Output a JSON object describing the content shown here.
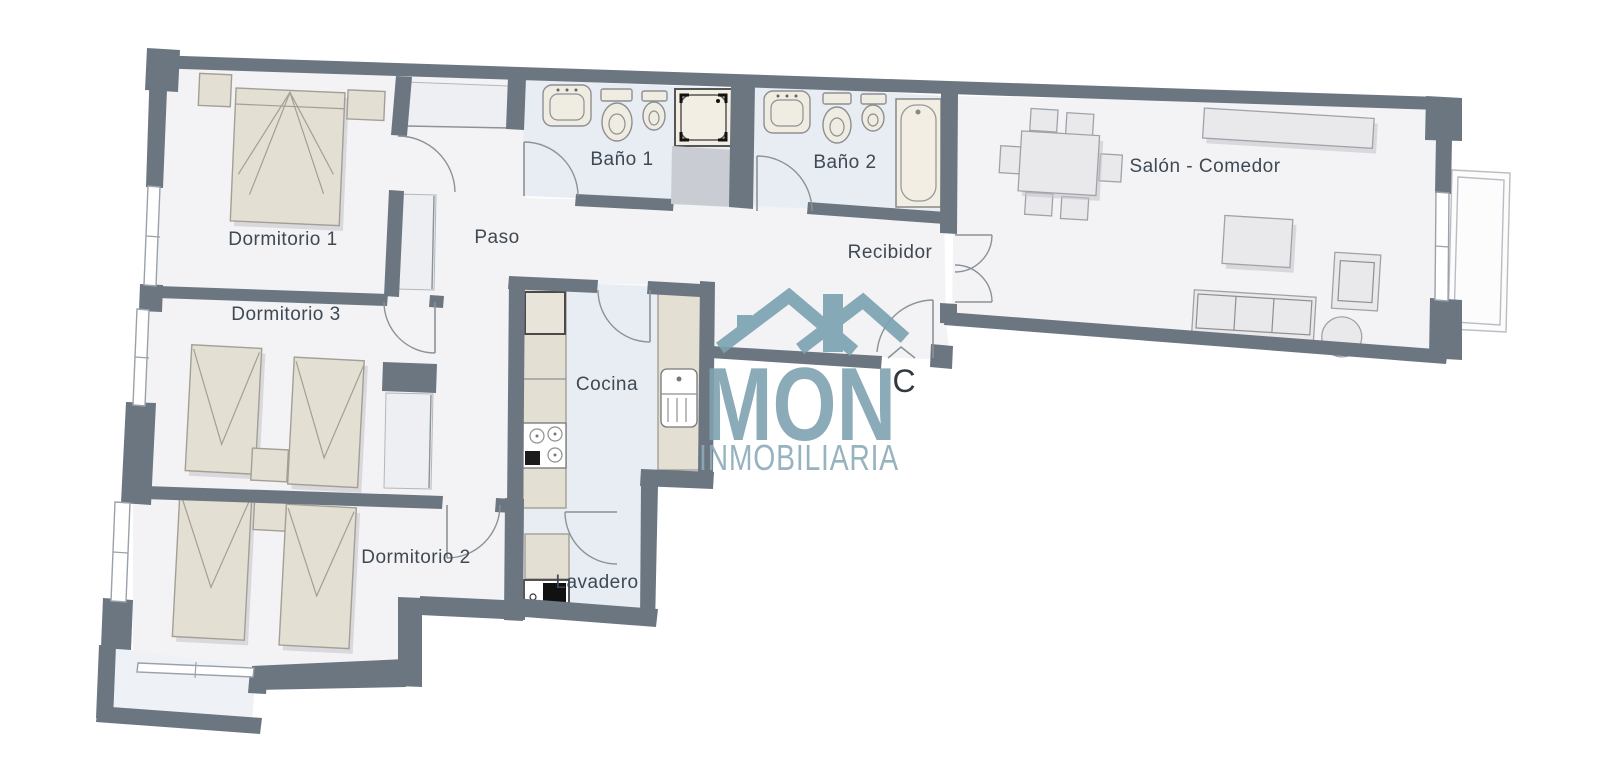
{
  "rooms": [
    {
      "id": "dormitorio-1",
      "label": "Dormitorio 1"
    },
    {
      "id": "dormitorio-3",
      "label": "Dormitorio 3"
    },
    {
      "id": "dormitorio-2",
      "label": "Dormitorio 2"
    },
    {
      "id": "paso",
      "label": "Paso"
    },
    {
      "id": "bano-1",
      "label": "Baño 1"
    },
    {
      "id": "bano-2",
      "label": "Baño 2"
    },
    {
      "id": "recibidor",
      "label": "Recibidor"
    },
    {
      "id": "salon-comedor",
      "label": "Salón - Comedor"
    },
    {
      "id": "cocina",
      "label": "Cocina"
    },
    {
      "id": "lavadero",
      "label": "Lavadero"
    }
  ],
  "entrance": {
    "label": "C"
  },
  "watermark": {
    "name": "MON",
    "tagline": "INMOBILIARIA"
  },
  "colors": {
    "wall": "#6b7681",
    "floor": "#f3f3f5",
    "wet_floor": "#e8ecf3",
    "furniture_beige": "#e4dfd3",
    "furniture_gray": "#e9e9eb",
    "watermark": "#80a2b1",
    "label_text": "#3e4954"
  }
}
